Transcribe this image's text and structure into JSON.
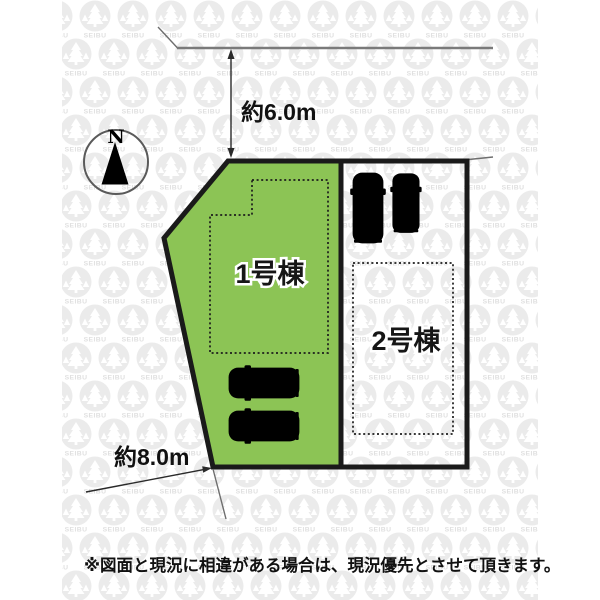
{
  "colors": {
    "lot1_green": "#8cc455",
    "border_black": "#1a1a1a",
    "road_gray": "#7a7a7a",
    "dim_color": "#2a2a2a",
    "car_gray": "#5e6f87",
    "car_gray_dark": "#2e3e54",
    "car_teal": "#79d0d8",
    "car_teal_dark": "#1f7580",
    "tail_red": "#a63430",
    "wm_gray": "#ebebeb",
    "wm_text_gray": "#e0e0e0"
  },
  "watermark": {
    "text": "SEIBU",
    "icon": "tree-logo-icon"
  },
  "compass": {
    "north_label": "N"
  },
  "dimensions": {
    "top_road_width": "約6.0m",
    "left_frontage": "約8.0m"
  },
  "lots": {
    "lot1": {
      "label": "1号棟"
    },
    "lot2": {
      "label": "2号棟"
    }
  },
  "cars": {
    "lot2_car_left": "gray-suv-top-view",
    "lot2_car_right": "teal-compact-top-view",
    "lot1_car_top": "gray-car-top-view",
    "lot1_car_bottom": "gray-car-top-view"
  },
  "footer": {
    "disclaimer": "※図面と現況に相違がある場合は、現況優先とさせて頂きます。"
  }
}
